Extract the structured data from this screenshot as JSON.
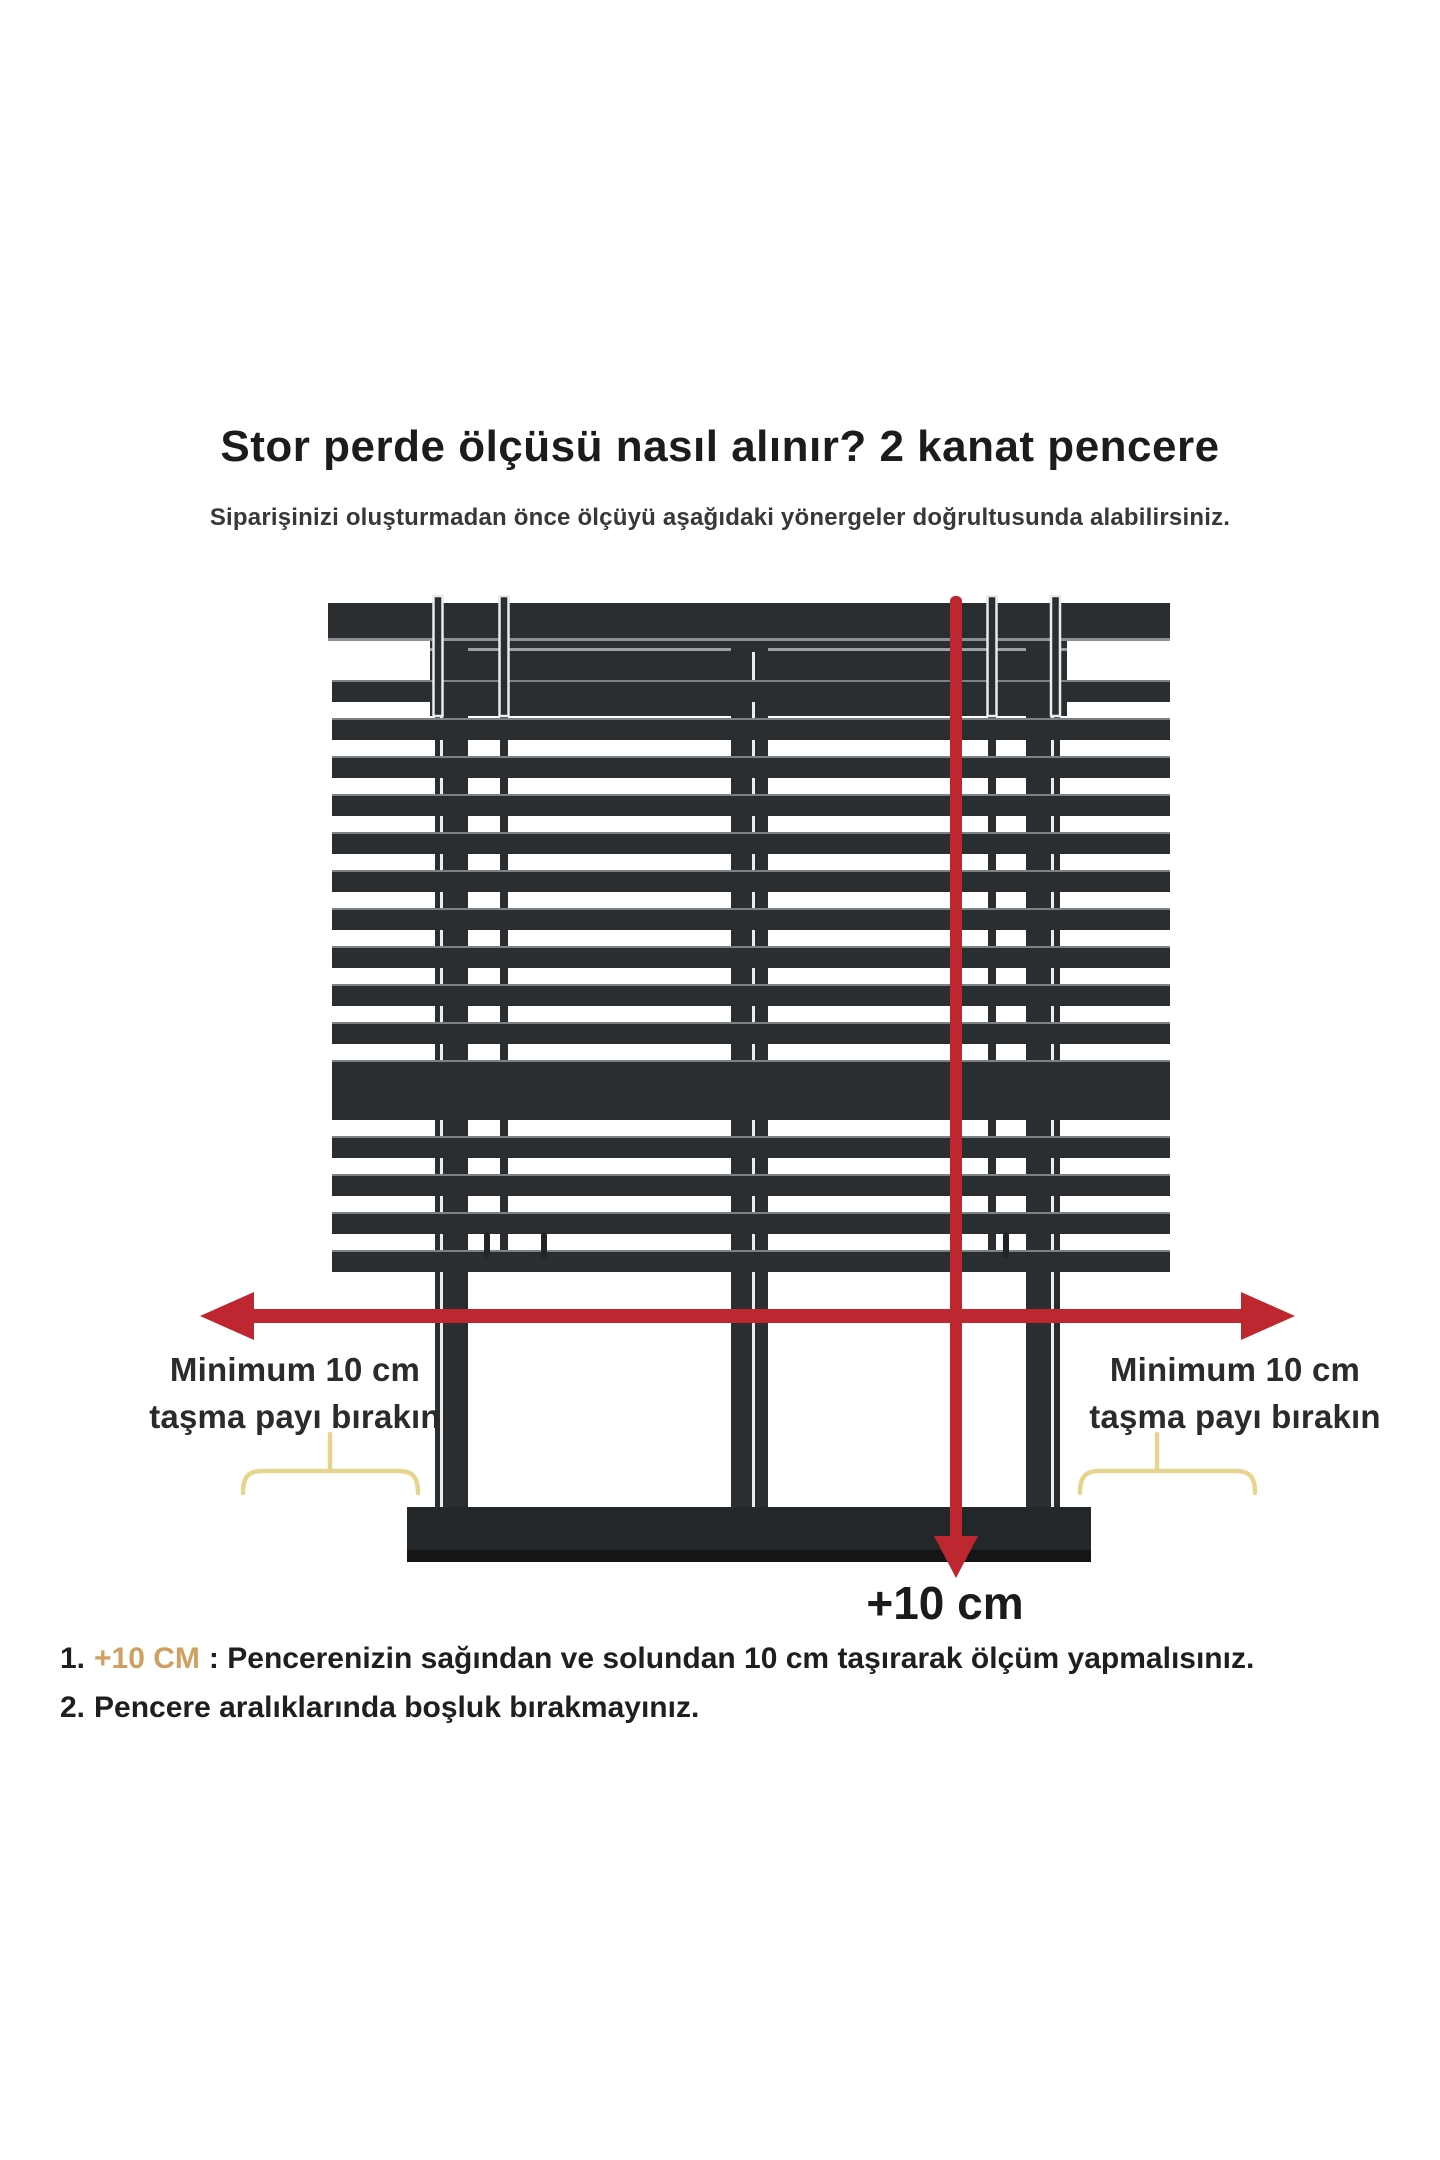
{
  "header": {
    "title": "Stor perde ölçüsü nasıl alınır? 2 kanat pencere",
    "subtitle": "Siparişinizi oluşturmadan önce ölçüyü aşağıdaki yönergeler doğrultusunda alabilirsiniz."
  },
  "diagram": {
    "overhang_labels": {
      "left": {
        "line1": "Minimum 10 cm",
        "line2": "taşma payı bırakın"
      },
      "right": {
        "line1": "Minimum 10 cm",
        "line2": "taşma payı bırakın"
      }
    },
    "bottom_measure_label": "+10 cm"
  },
  "instructions": [
    {
      "number": "1.",
      "highlight": "+10 CM",
      "text": ": Pencerenizin sağından ve solundan 10 cm taşırarak ölçüm yapmalısınız."
    },
    {
      "number": "2.",
      "highlight": "",
      "text": "Pencere aralıklarında boşluk bırakmayınız."
    }
  ],
  "colors": {
    "frame_dark": "#2b2e30",
    "sill_dark": "#131517",
    "arrow_red": "#bf2730",
    "brace_yellow": "#e5d58e",
    "highlight_orange": "#cfa062",
    "text_dark": "#1f1f1f"
  }
}
